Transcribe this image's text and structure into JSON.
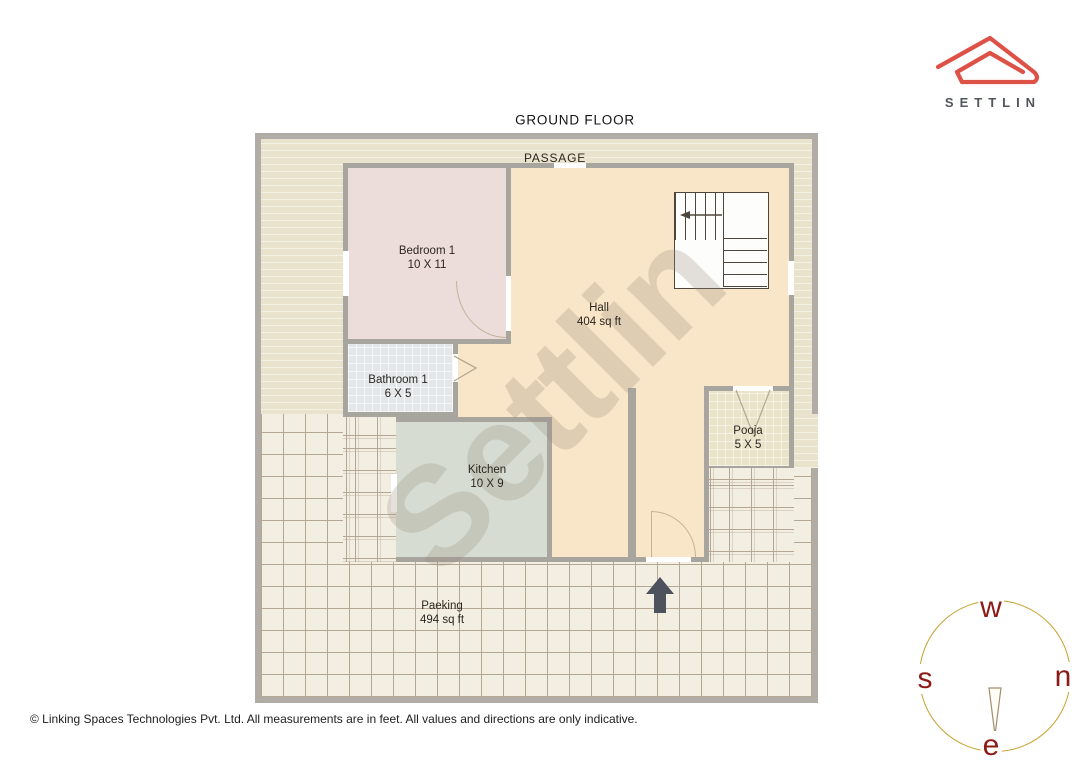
{
  "page": {
    "title": "GROUND FLOOR",
    "footer": "© Linking Spaces Technologies Pvt. Ltd. All measurements are in feet. All values and directions are only indicative."
  },
  "logo": {
    "brand": "SETTLIN"
  },
  "watermark": "Settlin",
  "plan": {
    "passage_label": "PASSAGE",
    "rooms": [
      {
        "id": "bedroom1",
        "name": "Bedroom 1",
        "size": "10 X 11"
      },
      {
        "id": "bathroom1",
        "name": "Bathroom 1",
        "size": "6 X 5"
      },
      {
        "id": "kitchen",
        "name": "Kitchen",
        "size": "10 X 9"
      },
      {
        "id": "hall",
        "name": "Hall",
        "size": "404 sq ft"
      },
      {
        "id": "pooja",
        "name": "Pooja",
        "size": "5 X 5"
      },
      {
        "id": "parking",
        "name": "Paeking",
        "size": "494 sq ft"
      }
    ],
    "features": [
      "staircase",
      "entrance-arrow",
      "passage"
    ]
  },
  "compass": {
    "top": "w",
    "right": "n",
    "left": "s",
    "bottom": "e",
    "ring_color": "#c5a22c",
    "letter_color": "#8c1b15"
  },
  "colors": {
    "logo_red": "#dd5147",
    "wall_gray": "#a8a49e",
    "hall_fill": "#f9e5c7",
    "bedroom_fill": "#ecdcda",
    "bathroom_fill": "#e3e7e9",
    "kitchen_fill": "#d7dcd2",
    "pooja_fill": "#e9e3c9",
    "passage_fill": "#e9e3cd",
    "parking_fill": "#f3eee2"
  }
}
